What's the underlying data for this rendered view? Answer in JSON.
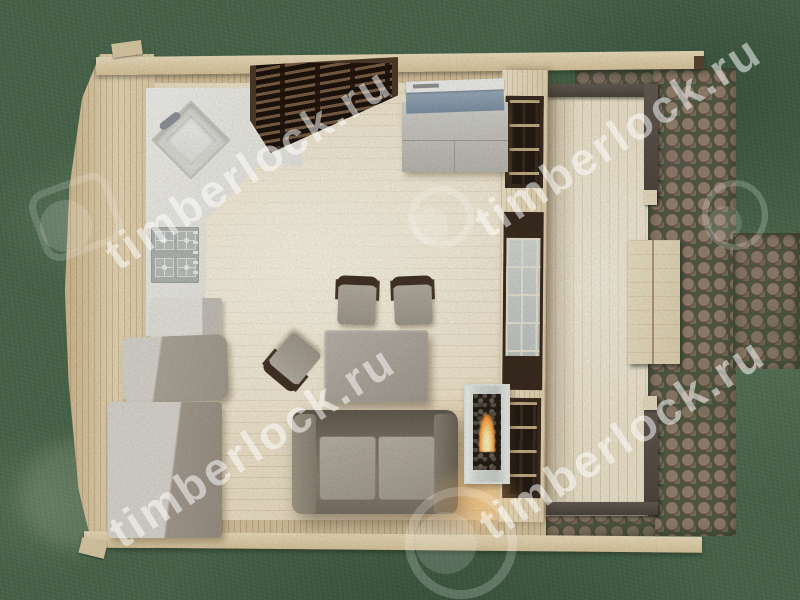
{
  "watermark": {
    "text": "timberlock.ru",
    "logo": "circle-lock-logo",
    "text_color": "rgba(255,255,255,0.52)",
    "instances": 4
  },
  "palette": {
    "lawn_green": "#4d6b4f",
    "cobblestone_brown": "#7c685a",
    "moss_joint_green": "#525c44",
    "wood_wall": "#e7d7b3",
    "interior_floor": "#f5ecd4",
    "terrace_deck": "#f2e8d0",
    "counter_white": "#f1f0ea",
    "appliance_taupe": "#b1aa9d",
    "sofa_taupe": "#7d7567",
    "cushion_gray": "#b2a99d",
    "window_frame_dark": "#3a2b1f",
    "railing_dark": "#57504a",
    "ac_panel_blue": "#8fa3b5",
    "flame_orange": "#ff9c3f"
  },
  "scene": {
    "type": "top-down 3D architectural render",
    "subject": "one-room timber cabin floor plan with side terrace",
    "environment": [
      "lawn",
      "cobblestone paving",
      "wooden plank walkway"
    ],
    "objects": [
      "l-shaped kitchen counter with corner sink and faucet",
      "four-burner gas hob with knobs",
      "dark slatted window on top wall",
      "gray cabinet with blue air-conditioner unit",
      "small appliance box",
      "rounded appliance cabinet",
      "refrigerator cabinet",
      "dining table",
      "two chairs at table",
      "pulled-out chair",
      "two-seat sofa with gray cushions",
      "glass bio-fireplace with flame and warm glow",
      "partition wall with three dark-framed windows",
      "terrace with dark railings and corner posts",
      "curved log gable wall",
      "top and bottom wall beams"
    ]
  }
}
